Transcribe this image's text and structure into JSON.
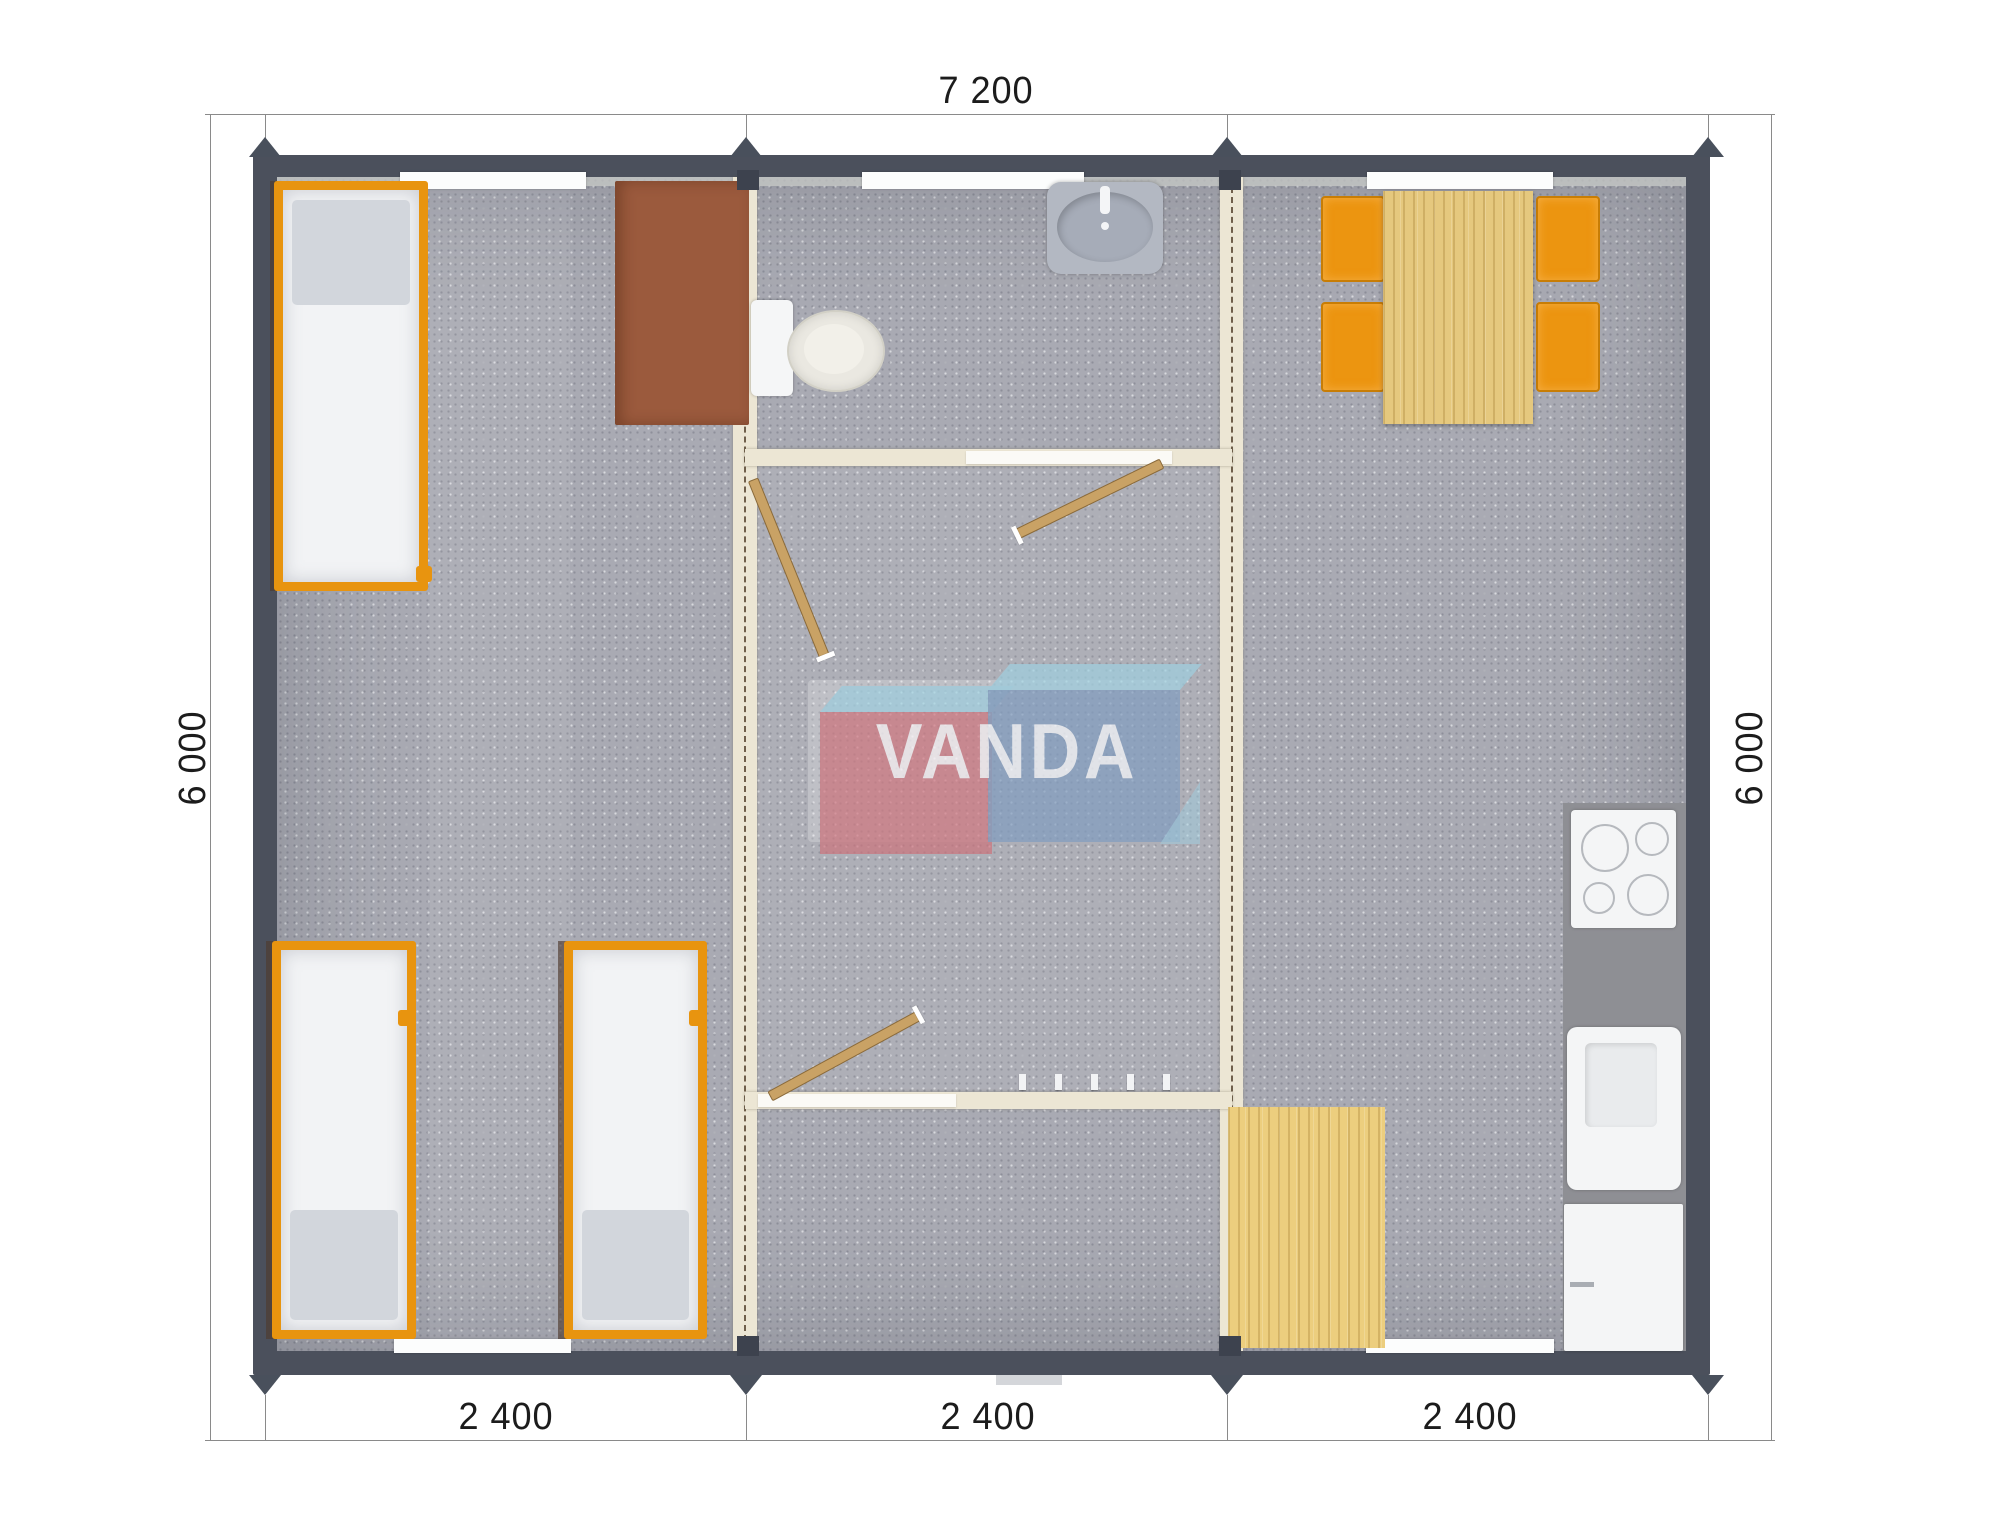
{
  "scene": {
    "type": "architectural floor plan render",
    "modules": 3,
    "watermark": "VANDA"
  },
  "dimensions": {
    "top": "7 200",
    "left": "6 000",
    "right": "6 000",
    "bottom": [
      "2 400",
      "2 400",
      "2 400"
    ]
  },
  "logo": {
    "text": "VANDA",
    "red_box_color": "#cf7079",
    "blue_box_color": "#7a98bc",
    "light_blue_color": "#9ed1e2"
  },
  "palette": {
    "wall": "#4b505c",
    "floor_carpet": "#a9aab3",
    "partition_cream": "#ece6d4",
    "furniture_orange": "#e8940f",
    "wood_light": "#e5c87e",
    "desk_brown": "#9b5a3d",
    "kitchen_counter": "#8e8f94",
    "fixture_white": "#f4f5f6"
  },
  "rooms": {
    "left_module": [
      "bed",
      "bed",
      "bed",
      "desk"
    ],
    "middle_module": [
      "washbasin",
      "toilet",
      "bathroom-door",
      "hall-door",
      "vestibule-door",
      "coat-hooks"
    ],
    "right_module": [
      "dining-table",
      "chair",
      "chair",
      "chair",
      "chair",
      "stove",
      "kitchen-sink",
      "fridge",
      "floor-mat"
    ]
  }
}
